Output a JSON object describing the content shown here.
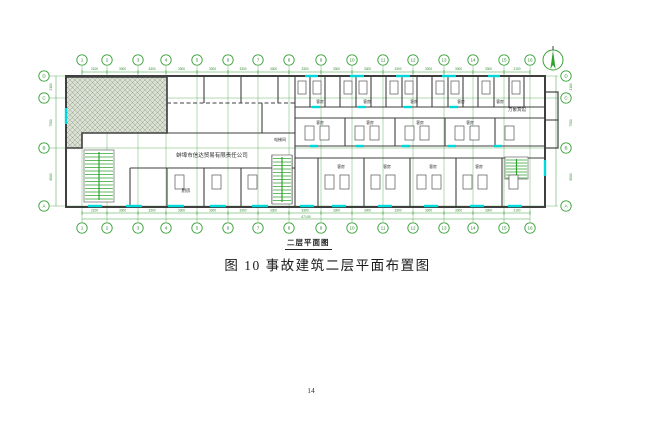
{
  "document": {
    "figure_label": "二层平面图",
    "caption": "图 10  事故建筑二层平面布置图",
    "page_number": "14"
  },
  "plan": {
    "colors": {
      "grid": "#3aa03a",
      "dim_text": "#2e8b2e",
      "wall": "#3f3f3f",
      "window": "#00d8dc",
      "hatch_fill": "#dae0d3",
      "hatch_line": "#9aa492",
      "stair": "#2fa32f",
      "label": "#2b2b2b"
    },
    "columns": {
      "labels": [
        "1",
        "2",
        "3",
        "4",
        "5",
        "6",
        "7",
        "8",
        "9",
        "10",
        "11",
        "12",
        "13",
        "14",
        "15",
        "16"
      ],
      "x": [
        82,
        107,
        138,
        166,
        197,
        228,
        258,
        289,
        321,
        352,
        383,
        413,
        444,
        473,
        504,
        530
      ],
      "cy_top": 60,
      "cy_bottom": 228
    },
    "rows": {
      "labels": [
        "D",
        "C",
        "B",
        "A"
      ],
      "y": [
        76,
        98,
        148,
        206
      ],
      "cx_left": 44,
      "cx_right": 566
    },
    "dims_top": [
      "2100",
      "3300",
      "3300",
      "3300",
      "3300",
      "3300",
      "3300",
      "3300",
      "3300",
      "3300",
      "3300",
      "3300",
      "3300",
      "3300",
      "2100"
    ],
    "dims_bottom": [
      "2100",
      "3300",
      "3300",
      "3300",
      "3300",
      "3300",
      "3300",
      "3300",
      "3300",
      "3300",
      "3300",
      "3300",
      "3300",
      "3300",
      "2100"
    ],
    "dims_left": [
      "2100",
      "7500",
      "6000"
    ],
    "dims_right": [
      "2100",
      "7500",
      "6000"
    ],
    "total_width_label": "47100",
    "outline": {
      "x": 66,
      "y": 76,
      "w": 479,
      "h": 131
    },
    "annex": {
      "x": 545,
      "y": 92,
      "w": 13,
      "h": 56
    },
    "hatch_poly": "66,77 167,77 167,133 82,133 82,148 66,148",
    "walls_h": [
      [
        167,
        295,
        133
      ],
      [
        295,
        545,
        107
      ],
      [
        295,
        545,
        118
      ],
      [
        295,
        545,
        146
      ],
      [
        295,
        545,
        158
      ],
      [
        130,
        295,
        168
      ],
      [
        545,
        558,
        120
      ]
    ],
    "walls_v": [
      [
        167,
        76,
        133
      ],
      [
        204,
        76,
        103
      ],
      [
        241,
        76,
        103
      ],
      [
        278,
        76,
        103
      ],
      [
        262,
        103,
        133
      ],
      [
        295,
        76,
        207
      ],
      [
        130,
        168,
        206
      ],
      [
        167,
        168,
        206
      ],
      [
        204,
        168,
        206
      ],
      [
        241,
        168,
        206
      ],
      [
        272,
        155,
        204
      ],
      [
        292,
        155,
        204
      ],
      [
        310,
        77,
        107
      ],
      [
        325,
        77,
        107
      ],
      [
        340,
        77,
        107
      ],
      [
        356,
        77,
        107
      ],
      [
        371,
        77,
        107
      ],
      [
        386,
        77,
        107
      ],
      [
        402,
        77,
        107
      ],
      [
        417,
        77,
        107
      ],
      [
        432,
        77,
        107
      ],
      [
        448,
        77,
        107
      ],
      [
        463,
        77,
        107
      ],
      [
        478,
        77,
        107
      ],
      [
        494,
        77,
        107
      ],
      [
        509,
        77,
        107
      ],
      [
        524,
        77,
        107
      ],
      [
        345,
        118,
        146
      ],
      [
        395,
        118,
        146
      ],
      [
        445,
        118,
        146
      ],
      [
        495,
        118,
        146
      ],
      [
        318,
        158,
        206
      ],
      [
        364,
        158,
        206
      ],
      [
        410,
        158,
        206
      ],
      [
        456,
        158,
        206
      ],
      [
        502,
        158,
        206
      ]
    ],
    "dashed_h": [
      [
        167,
        295,
        103
      ]
    ],
    "windows_h": [
      [
        88,
        102,
        206
      ],
      [
        126,
        142,
        206
      ],
      [
        168,
        184,
        206
      ],
      [
        210,
        226,
        206
      ],
      [
        252,
        268,
        206
      ],
      [
        300,
        314,
        206
      ],
      [
        332,
        346,
        206
      ],
      [
        378,
        392,
        206
      ],
      [
        424,
        438,
        206
      ],
      [
        470,
        484,
        206
      ],
      [
        508,
        522,
        206
      ],
      [
        305,
        318,
        76
      ],
      [
        350,
        364,
        76
      ],
      [
        396,
        410,
        76
      ],
      [
        442,
        456,
        76
      ],
      [
        488,
        500,
        76
      ],
      [
        310,
        318,
        146
      ],
      [
        356,
        364,
        146
      ],
      [
        402,
        410,
        146
      ],
      [
        448,
        456,
        146
      ],
      [
        494,
        502,
        146
      ],
      [
        312,
        320,
        107
      ],
      [
        358,
        366,
        107
      ],
      [
        404,
        412,
        107
      ],
      [
        450,
        458,
        107
      ]
    ],
    "windows_v": [
      [
        66,
        108,
        124
      ],
      [
        545,
        160,
        176
      ]
    ],
    "stairs": [
      {
        "x": 84,
        "y": 150,
        "w": 30,
        "h": 52,
        "step": 3.5
      },
      {
        "x": 272,
        "y": 155,
        "w": 20,
        "h": 49,
        "step": 3.5
      },
      {
        "x": 505,
        "y": 157,
        "w": 23,
        "h": 22,
        "step": 3.0
      }
    ],
    "beds": [
      [
        298,
        81,
        8,
        13
      ],
      [
        313,
        81,
        8,
        13
      ],
      [
        344,
        81,
        8,
        13
      ],
      [
        359,
        81,
        8,
        13
      ],
      [
        390,
        81,
        8,
        13
      ],
      [
        405,
        81,
        8,
        13
      ],
      [
        436,
        81,
        8,
        13
      ],
      [
        451,
        81,
        8,
        13
      ],
      [
        482,
        81,
        8,
        13
      ],
      [
        512,
        81,
        8,
        13
      ],
      [
        305,
        126,
        9,
        14
      ],
      [
        320,
        126,
        9,
        14
      ],
      [
        355,
        126,
        9,
        14
      ],
      [
        370,
        126,
        9,
        14
      ],
      [
        405,
        126,
        9,
        14
      ],
      [
        420,
        126,
        9,
        14
      ],
      [
        455,
        126,
        9,
        14
      ],
      [
        470,
        126,
        9,
        14
      ],
      [
        505,
        126,
        9,
        14
      ],
      [
        325,
        175,
        9,
        14
      ],
      [
        340,
        175,
        9,
        14
      ],
      [
        371,
        175,
        9,
        14
      ],
      [
        386,
        175,
        9,
        14
      ],
      [
        417,
        175,
        9,
        14
      ],
      [
        432,
        175,
        9,
        14
      ],
      [
        463,
        175,
        9,
        14
      ],
      [
        478,
        175,
        9,
        14
      ],
      [
        509,
        175,
        9,
        14
      ],
      [
        175,
        175,
        9,
        14
      ],
      [
        212,
        175,
        9,
        14
      ],
      [
        248,
        175,
        9,
        14
      ]
    ],
    "labels": [
      {
        "t": "蚌埠市信达贸易有限责任公司",
        "x": 212,
        "y": 157,
        "s": 5.5
      },
      {
        "t": "厨房",
        "x": 186,
        "y": 192,
        "s": 4.5
      },
      {
        "t": "电梯间",
        "x": 280,
        "y": 141,
        "s": 4.0
      },
      {
        "t": "万象宾馆",
        "x": 517,
        "y": 111,
        "s": 4.5
      },
      {
        "t": "客房",
        "x": 320,
        "y": 103,
        "s": 3.8
      },
      {
        "t": "客房",
        "x": 367,
        "y": 103,
        "s": 3.8
      },
      {
        "t": "客房",
        "x": 414,
        "y": 103,
        "s": 3.8
      },
      {
        "t": "客房",
        "x": 461,
        "y": 103,
        "s": 3.8
      },
      {
        "t": "客房",
        "x": 500,
        "y": 103,
        "s": 3.8
      },
      {
        "t": "客房",
        "x": 320,
        "y": 124,
        "s": 3.8
      },
      {
        "t": "客房",
        "x": 370,
        "y": 124,
        "s": 3.8
      },
      {
        "t": "客房",
        "x": 420,
        "y": 124,
        "s": 3.8
      },
      {
        "t": "客房",
        "x": 470,
        "y": 124,
        "s": 3.8
      },
      {
        "t": "客房",
        "x": 341,
        "y": 168,
        "s": 3.8
      },
      {
        "t": "客房",
        "x": 387,
        "y": 168,
        "s": 3.8
      },
      {
        "t": "客房",
        "x": 433,
        "y": 168,
        "s": 3.8
      },
      {
        "t": "客房",
        "x": 479,
        "y": 168,
        "s": 3.8
      }
    ],
    "north": {
      "cx": 553,
      "cy": 60,
      "r": 10
    }
  }
}
